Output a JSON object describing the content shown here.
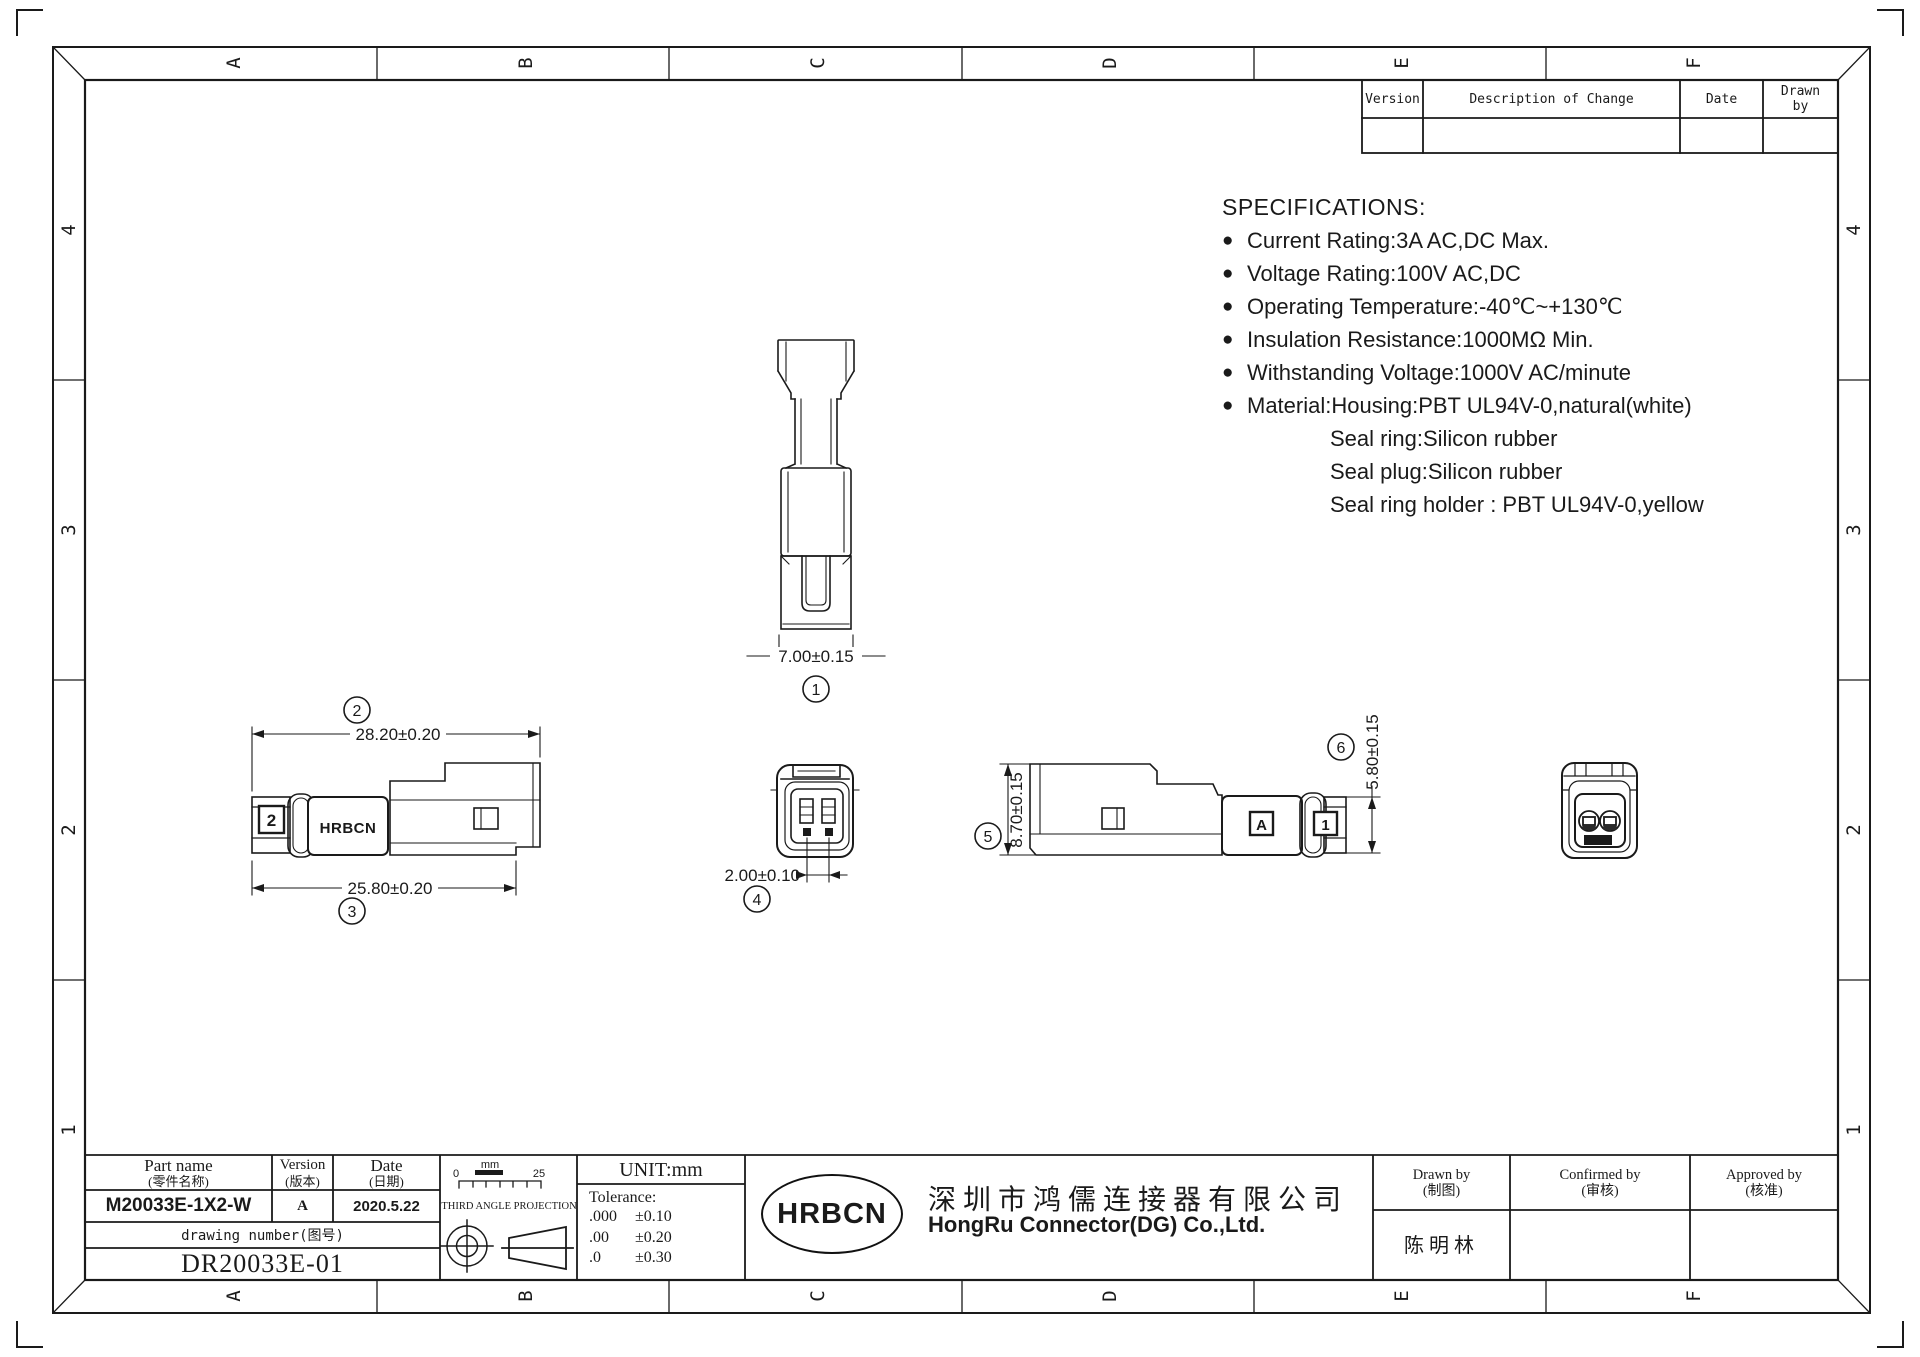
{
  "grid": {
    "cols": [
      "A",
      "B",
      "C",
      "D",
      "E",
      "F"
    ],
    "rows": [
      "4",
      "3",
      "2",
      "1"
    ]
  },
  "revision_table": {
    "headers": {
      "version": "Version",
      "description": "Description of Change",
      "date": "Date",
      "drawn_by": "Drawn by"
    }
  },
  "specifications": {
    "title": "SPECIFICATIONS:",
    "items": [
      {
        "bullet": "●",
        "text": "Current Rating:3A AC,DC Max."
      },
      {
        "bullet": "●",
        "text": "Voltage Rating:100V AC,DC"
      },
      {
        "bullet": "●",
        "text": "Operating Temperature:-40℃~+130℃"
      },
      {
        "bullet": "●",
        "text": "Insulation Resistance:1000MΩ Min."
      },
      {
        "bullet": "●",
        "text": "Withstanding Voltage:1000V AC/minute"
      },
      {
        "bullet": "●",
        "text": "Material:Housing:PBT UL94V-0,natural(white)"
      },
      {
        "bullet": "",
        "text": "Seal ring:Silicon rubber"
      },
      {
        "bullet": "",
        "text": "Seal plug:Silicon rubber"
      },
      {
        "bullet": "",
        "text": "Seal ring holder : PBT UL94V-0,yellow"
      }
    ]
  },
  "views": {
    "front_top": {
      "balloon": "1",
      "dim_width": "7.00±0.15"
    },
    "side_left": {
      "balloon_top": "2",
      "dim_top": "28.20±0.20",
      "balloon_bottom": "3",
      "dim_bottom": "25.80±0.20",
      "brand_text": "HRBCN",
      "cavity_label": "2"
    },
    "front": {
      "balloon": "4",
      "dim_pitch": "2.00±0.10"
    },
    "side_right": {
      "balloon_height": "5",
      "dim_height": "8.70±0.15",
      "balloon_cap": "6",
      "dim_cap": "5.80±0.15",
      "section_label": "A",
      "cavity_label": "1"
    }
  },
  "title_block": {
    "part_name_label": "Part name",
    "part_name_label_cn": "(零件名称)",
    "version_label": "Version",
    "version_label_cn": "(版本)",
    "date_label": "Date",
    "date_label_cn": "(日期)",
    "part_name": "M20033E-1X2-W",
    "version": "A",
    "date": "2020.5.22",
    "drawing_number_label": "drawing number(图号)",
    "drawing_number": "DR20033E-01",
    "projection_label": "THIRD ANGLE PROJECTION",
    "scale": {
      "start": "0",
      "unit": "mm",
      "end": "25"
    },
    "unit_label": "UNIT:mm",
    "tolerance_label": "Tolerance:",
    "tolerances": [
      {
        "digits": ".000",
        "value": "±0.10"
      },
      {
        "digits": ".00",
        "value": "±0.20"
      },
      {
        "digits": ".0",
        "value": "±0.30"
      }
    ],
    "logo": "HRBCN",
    "company_cn": "深圳市鸿儒连接器有限公司",
    "company_en": "HongRu Connector(DG) Co.,Ltd.",
    "drawn_by_label": "Drawn by",
    "drawn_by_label_cn": "(制图)",
    "drawn_by": "陈明林",
    "confirmed_by_label": "Confirmed by",
    "confirmed_by_label_cn": "(审核)",
    "approved_by_label": "Approved by",
    "approved_by_label_cn": "(核准)"
  }
}
